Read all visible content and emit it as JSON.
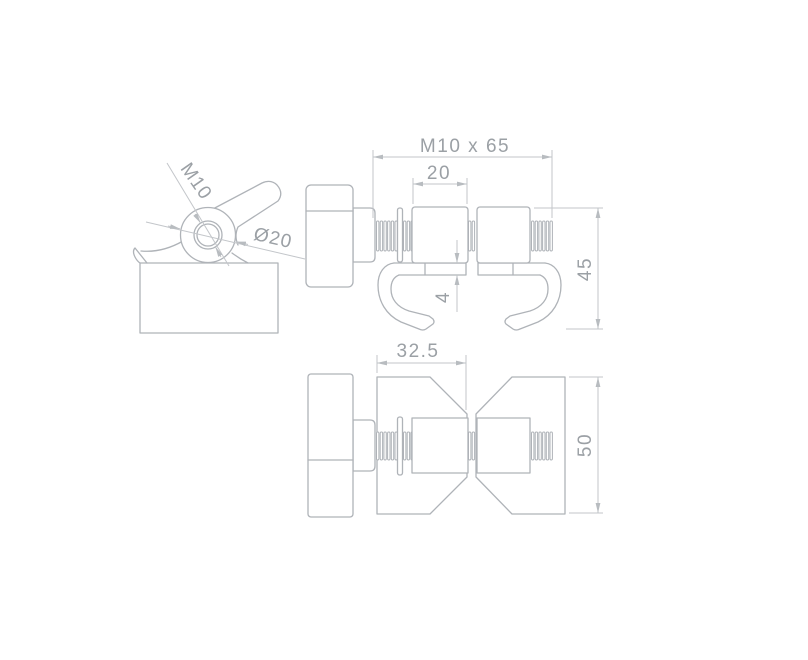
{
  "side_view": {
    "thread_label": "M10",
    "diameter_label": "Ø20"
  },
  "front_view": {
    "rod_label": "M10 x 65",
    "block_width_label": "20",
    "height_label": "45",
    "plate_thickness_label": "4"
  },
  "top_view": {
    "width_label": "32.5",
    "depth_label": "50"
  },
  "colors": {
    "part_line": "#afb3b8",
    "dim_line": "#c3c6ca",
    "label_text": "#9ba0a5",
    "background": "#ffffff"
  }
}
